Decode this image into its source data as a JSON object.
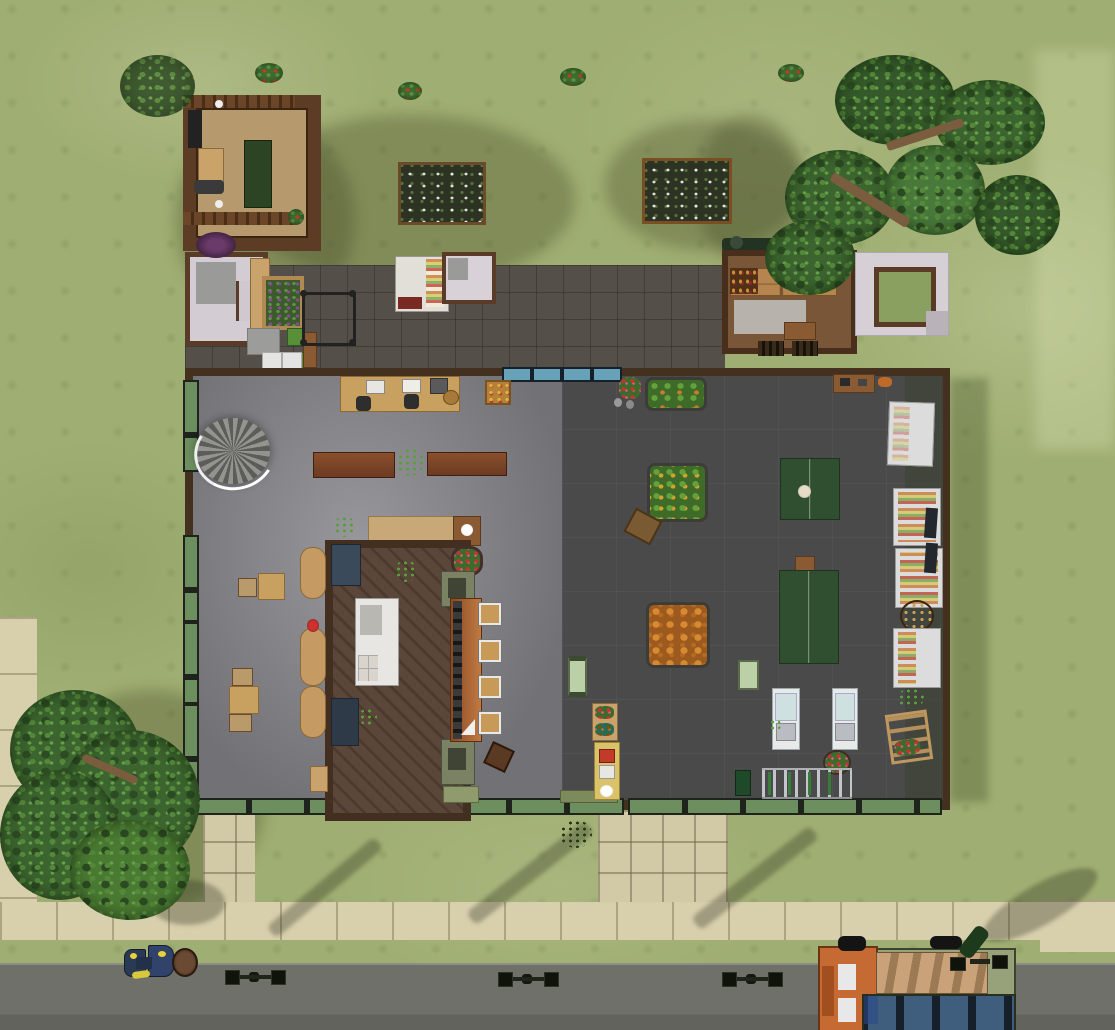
{
  "scene": {
    "description": "Top-down life-simulation game screenshot of a grocery market community lot",
    "view": "overhead lot view, no HUD or text visible",
    "areas": [
      "front lawn with pergola and garden plots",
      "slate patio with restrooms and snack bar",
      "market store building",
      "street with sidewalk, lamps, motorcycle and bus"
    ]
  },
  "palette": {
    "grass": "#9fae72",
    "grassDark": "#7f9157",
    "patio": "#544f49",
    "sidewalk": "#d8cfad",
    "road": "#70706a",
    "wall": "#44301f",
    "floorLight": "#8f8f93",
    "floorDark": "#4b4b4b",
    "kitchenFloor": "#57453a",
    "glassGreen": "#6d8f60",
    "glassBlue": "#68a2b8",
    "woodLight": "#c8a05f",
    "woodMid": "#8a5a33",
    "woodDark": "#5a3b28",
    "terracotta": "#b06537",
    "tableGreen": "#2f4f30",
    "produceGreen": "#4d7a33",
    "produceOrange": "#c87b2e",
    "shelfWhite": "#dcdcdc",
    "beltBlue": "#cfe0e0",
    "busOrange": "#c56a33",
    "busBody": "#97a27b",
    "busWindow": "#3f5d7d"
  },
  "objects": {
    "exterior": [
      "wooden pergola",
      "flower garden plot",
      "vegetable garden plot",
      "red flower bushes",
      "large oak tree",
      "lush street tree",
      "restroom hut west",
      "restroom hut east",
      "storage shed",
      "snack bar room",
      "barbecue grills",
      "food display stand",
      "planter box",
      "climbing frame",
      "patio chairs",
      "trash bins"
    ],
    "store_interior": [
      "office desk with computers",
      "spiral staircase",
      "display benches",
      "potted palms",
      "service counter",
      "kitchen with stove",
      "juice bar counter with taps",
      "bar stools",
      "lounge seats",
      "dining tables",
      "produce bin greens",
      "produce bin squash",
      "produce bin pumpkins",
      "green market tables",
      "grocery shelf units",
      "refrigerated shelves",
      "display barrel",
      "flower ladder display",
      "checkout register 1",
      "checkout register 2",
      "shopping cart rack",
      "espresso stand",
      "flower shelf",
      "scale kiosks",
      "trash can",
      "round flower planter",
      "fruit crate",
      "ottoman"
    ],
    "street": [
      "sidewalk",
      "asphalt road",
      "street lamp 1",
      "street lamp 2",
      "street lamp 3",
      "street lamp 4",
      "parked motorcycle",
      "curbside trash can",
      "city bus"
    ]
  }
}
